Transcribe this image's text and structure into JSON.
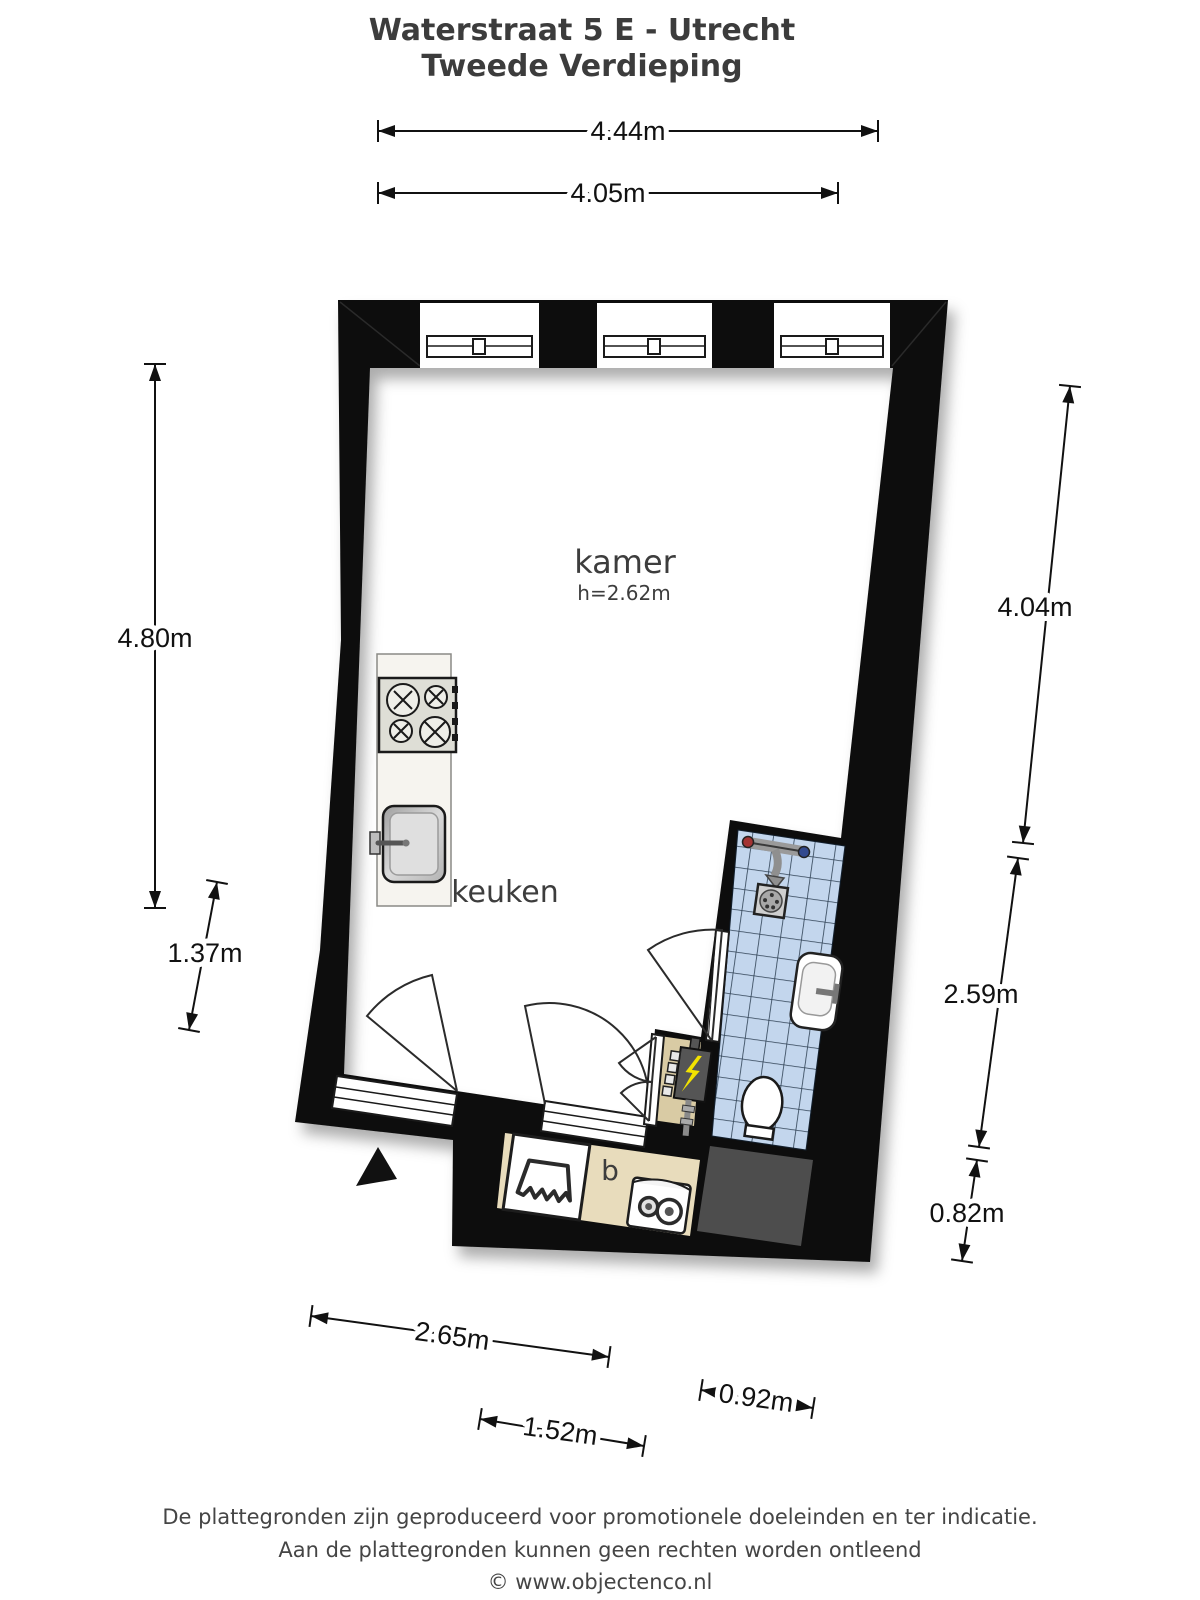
{
  "title": {
    "line1": "Waterstraat 5 E - Utrecht",
    "line2": "Tweede Verdieping"
  },
  "rooms": {
    "kamer": {
      "label": "kamer",
      "height_note": "h=2.62m"
    },
    "keuken": {
      "label": "keuken"
    },
    "b": {
      "label": "b"
    }
  },
  "dimensions": {
    "top_outer": "4.44m",
    "top_inner": "4.05m",
    "left_main": "4.80m",
    "left_lower": "1.37m",
    "right_upper": "4.04m",
    "right_middle": "2.59m",
    "right_lower": "0.82m",
    "bottom_main": "2.65m",
    "bottom_inner": "1.52m",
    "bottom_right": "0.92m"
  },
  "footer": {
    "line1": "De plattegronden zijn geproduceerd voor promotionele doeleinden en ter indicatie.",
    "line2": "Aan de plattegronden kunnen geen rechten worden ontleend",
    "line3": "© www.objectenco.nl"
  },
  "icons": {
    "stove": "stove-icon",
    "sink": "kitchen-sink-icon",
    "shower_mixer": "shower-mixer-icon",
    "drain": "shower-drain-icon",
    "washbasin": "washbasin-icon",
    "toilet": "toilet-icon",
    "fuse_box": "fuse-box-icon",
    "shower_tray": "shower-tray-icon",
    "washing_machine": "washing-machine-icon",
    "north_arrow": "entrance-arrow-icon"
  },
  "colors": {
    "wall": "#0d0d0d",
    "kamer_floor": "#f3d7a3",
    "b_floor": "#e8dcbc",
    "meter_floor": "#d9cba4",
    "shaft": "#4d4d4d",
    "tile": "#c3d6ed",
    "tile_grid": "#2f4154",
    "counter": "#f6f4ef"
  }
}
